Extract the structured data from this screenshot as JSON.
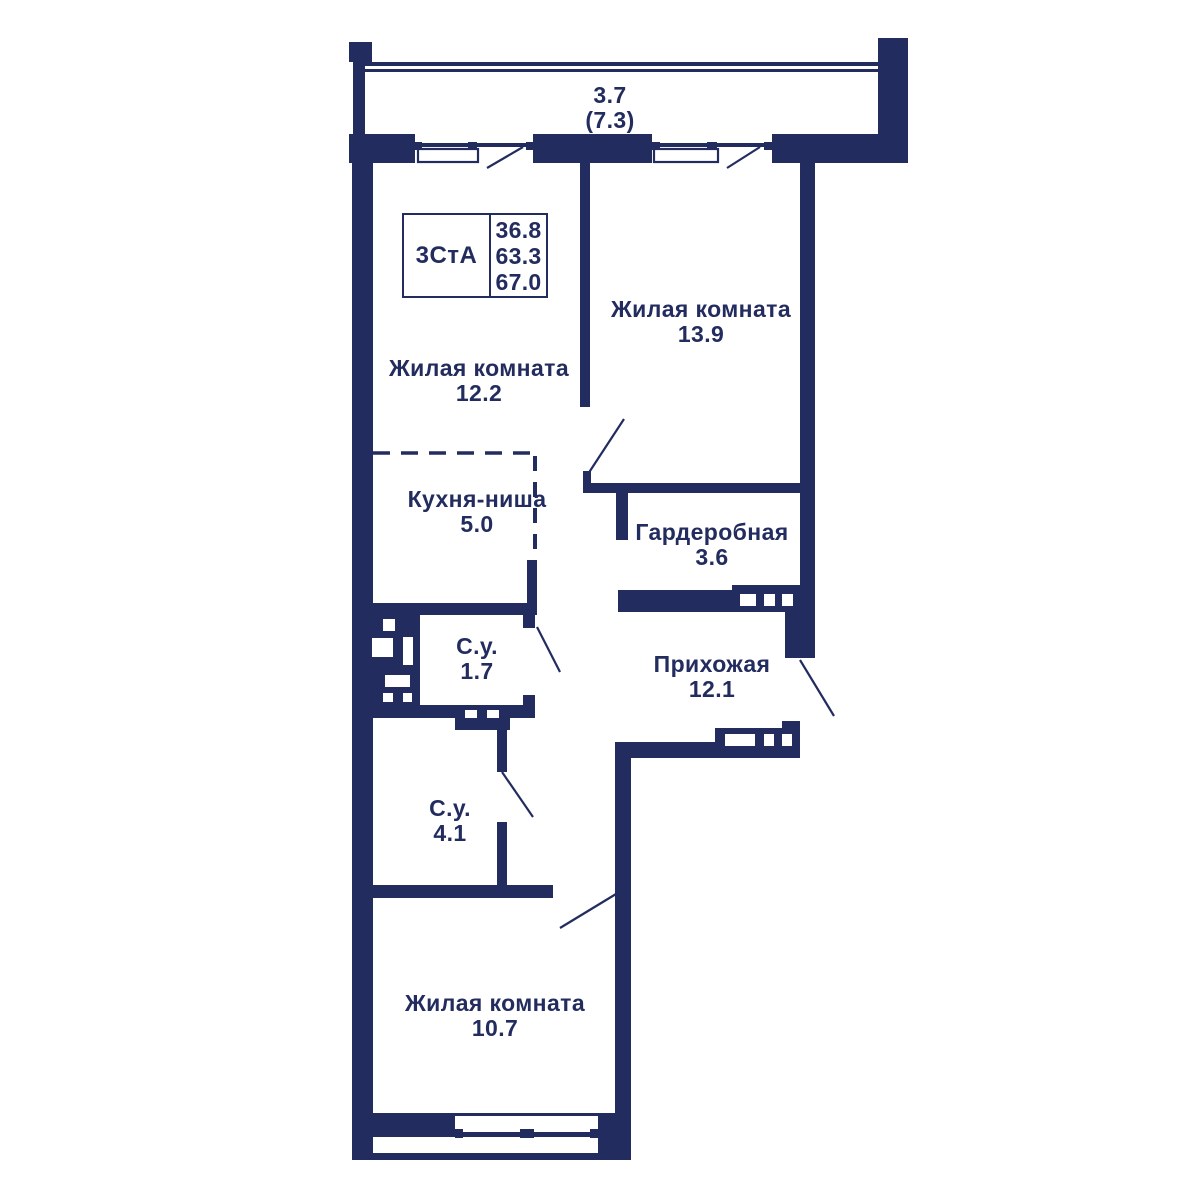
{
  "plan": {
    "colors": {
      "wall": "#232c5e",
      "background": "#ffffff"
    },
    "balcony": {
      "area": "3.7",
      "area_total": "(7.3)"
    },
    "title_block": {
      "type_label": "3СтА",
      "area_living": "36.8",
      "area_main": "63.3",
      "area_total": "67.0"
    },
    "rooms": [
      {
        "id": "living-13-9",
        "name": "Жилая комната",
        "area": "13.9"
      },
      {
        "id": "living-12-2",
        "name": "Жилая комната",
        "area": "12.2"
      },
      {
        "id": "kitchen-niche",
        "name": "Кухня-ниша",
        "area": "5.0"
      },
      {
        "id": "wardrobe",
        "name": "Гардеробная",
        "area": "3.6"
      },
      {
        "id": "bathroom-small",
        "name": "С.у.",
        "area": "1.7"
      },
      {
        "id": "hallway",
        "name": "Прихожая",
        "area": "12.1"
      },
      {
        "id": "bathroom-big",
        "name": "С.у.",
        "area": "4.1"
      },
      {
        "id": "living-10-7",
        "name": "Жилая комната",
        "area": "10.7"
      }
    ]
  }
}
